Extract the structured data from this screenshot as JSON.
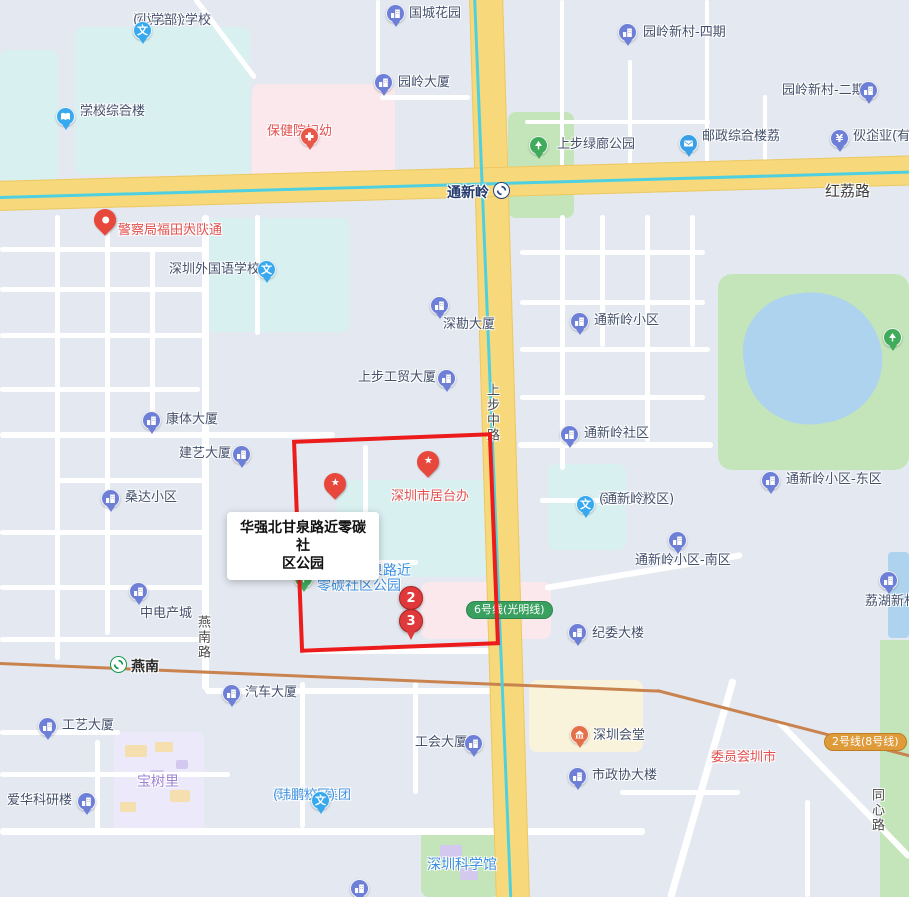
{
  "map": {
    "selection_tooltip": {
      "line1": "华强北甘泉路近零碳社",
      "line2": "区公园"
    },
    "selection_rect_color": "#ed1c1c",
    "colors": {
      "icon_building": "#6d7fd6",
      "icon_school": "#38a9ef",
      "icon_park": "#41ab5c",
      "icon_hospital": "#e8584a",
      "icon_hall_orange": "#e4704a",
      "icon_postal": "#389fe8",
      "pin_red": "#e8473b",
      "marker_red": "#e0393b",
      "label_navy": "#44516d",
      "label_red": "#e25050",
      "label_blue": "#3d8fe0",
      "label_purple": "#9d85d2",
      "line6_green": "#3aa05f",
      "line2_orange": "#df9b3a",
      "road_yellow": "#f7d97b",
      "railway_orange": "#c9834f",
      "metro_cyan": "#4fd0e0"
    },
    "road_labels": [
      {
        "text": "红荔路",
        "x": 825,
        "y": 180,
        "vertical": false,
        "big": true
      },
      {
        "text": "上步中路",
        "x": 482,
        "y": 383,
        "vertical": true,
        "big": false
      },
      {
        "text": "燕南路",
        "x": 193,
        "y": 615,
        "vertical": true,
        "big": false
      },
      {
        "text": "同心路",
        "x": 867,
        "y": 788,
        "vertical": true,
        "big": false
      }
    ],
    "stations": [
      {
        "name": "tongxinling-station",
        "label": "通新岭",
        "icon_x": 501,
        "icon_y": 190,
        "label_x": 436,
        "label_y": 182,
        "logo_color": "#27457c",
        "label_color": "#223a6d"
      },
      {
        "name": "yannan-station",
        "label": "燕南",
        "icon_x": 118,
        "icon_y": 664,
        "label_x": 131,
        "label_y": 656,
        "logo_color": "#14984f",
        "label_color": "#2a2a2a"
      }
    ],
    "metro_badges": [
      {
        "name": "line6-badge",
        "label": "6号线(光明线)",
        "x": 466,
        "y": 601,
        "bg": "#3aa05f",
        "border": "#2e8450"
      },
      {
        "name": "line2-badge",
        "label": "2号线(8号线)",
        "x": 824,
        "y": 733,
        "bg": "#df9b3a",
        "border": "#bf7d22"
      }
    ],
    "numbered_markers": [
      {
        "name": "route-marker-2",
        "n": "2",
        "x": 411,
        "y": 598,
        "shape": "circle"
      },
      {
        "name": "route-marker-3",
        "n": "3",
        "x": 411,
        "y": 621,
        "shape": "pin"
      }
    ],
    "pins": [
      {
        "name": "star-pin-jutaiban",
        "kind": "star",
        "x": 428,
        "y": 475
      },
      {
        "name": "star-pin-obscured",
        "kind": "star",
        "x": 335,
        "y": 497
      },
      {
        "name": "police-pin",
        "kind": "dot",
        "x": 105,
        "y": 233
      },
      {
        "name": "selected-place-pin",
        "kind": "sel",
        "x": 325,
        "y": 570
      }
    ],
    "pois": [
      {
        "name": "sz-experimental-primary",
        "icon": "school",
        "ix": 143,
        "iy": 31,
        "lines": [
          "深圳实验学校",
          "(小学部)"
        ],
        "lx": 133,
        "ly": 14,
        "align": "r",
        "color": "navy"
      },
      {
        "name": "guocheng-garden",
        "icon": "building",
        "ix": 396,
        "iy": 14,
        "lines": [
          "国城花园"
        ],
        "lx": 409,
        "ly": 7,
        "align": "l",
        "color": "navy"
      },
      {
        "name": "experimental-complex",
        "icon": "book",
        "ix": 66,
        "iy": 117,
        "lines": [
          "深圳实验",
          "学校综合楼"
        ],
        "lx": 80,
        "ly": 105,
        "align": "l",
        "color": "navy"
      },
      {
        "name": "fuyou-hospital",
        "icon": "hospital",
        "ix": 310,
        "iy": 137,
        "lines": [
          "深圳市妇幼",
          "保健院"
        ],
        "lx": 267,
        "ly": 125,
        "align": "c",
        "color": "red"
      },
      {
        "name": "yuanling-building",
        "icon": "building",
        "ix": 384,
        "iy": 83,
        "lines": [
          "园岭大厦"
        ],
        "lx": 398,
        "ly": 76,
        "align": "l",
        "color": "navy"
      },
      {
        "name": "yuanling-xincun-4",
        "icon": "building",
        "ix": 628,
        "iy": 33,
        "lines": [
          "园岭新村-四期"
        ],
        "lx": 643,
        "ly": 26,
        "align": "l",
        "color": "navy"
      },
      {
        "name": "yuanling-xincun-2",
        "icon": "building",
        "ix": 869,
        "iy": 91,
        "lines": [
          "园岭新村-二期"
        ],
        "lx": 782,
        "ly": 84,
        "align": "l",
        "color": "navy"
      },
      {
        "name": "lvlang-park",
        "icon": "park",
        "ix": 539,
        "iy": 146,
        "lines": [
          "上步绿廊公园"
        ],
        "lx": 557,
        "ly": 138,
        "align": "l",
        "color": "navy"
      },
      {
        "name": "china-post-hongli",
        "icon": "postal",
        "ix": 689,
        "iy": 144,
        "lines": [
          "中国邮政红荔",
          "邮政综合楼"
        ],
        "lx": 702,
        "ly": 130,
        "align": "l",
        "color": "navy"
      },
      {
        "name": "dream-factory-partnership",
        "icon": "money",
        "ix": 840,
        "iy": 139,
        "lines": [
          "深圳梦厂投",
          "伙企业(有限"
        ],
        "lx": 853,
        "ly": 130,
        "align": "l",
        "color": "navy"
      },
      {
        "name": "traffic-police-futian",
        "icon": null,
        "ix": 0,
        "iy": 0,
        "lines": [
          "深圳市公安局交通",
          "警察局福田大队"
        ],
        "lx": 118,
        "ly": 224,
        "align": "l",
        "color": "red"
      },
      {
        "name": "foreign-language-school",
        "icon": "school",
        "ix": 267,
        "iy": 270,
        "lines": [
          "深圳外国语学校"
        ],
        "lx": 169,
        "ly": 263,
        "align": "l",
        "color": "navy"
      },
      {
        "name": "shenkan-building",
        "icon": "building",
        "ix": 440,
        "iy": 306,
        "lines": [
          "深勘大厦"
        ],
        "lx": 443,
        "ly": 318,
        "align": "c",
        "color": "navy"
      },
      {
        "name": "shangbu-trade-building",
        "icon": "building",
        "ix": 447,
        "iy": 379,
        "lines": [
          "上步工贸大厦"
        ],
        "lx": 358,
        "ly": 371,
        "align": "l",
        "color": "navy"
      },
      {
        "name": "kangti-building",
        "icon": "building",
        "ix": 152,
        "iy": 421,
        "lines": [
          "康体大厦"
        ],
        "lx": 166,
        "ly": 413,
        "align": "l",
        "color": "navy"
      },
      {
        "name": "jianyi-building",
        "icon": "building",
        "ix": 242,
        "iy": 455,
        "lines": [
          "建艺大厦"
        ],
        "lx": 179,
        "ly": 447,
        "align": "l",
        "color": "navy"
      },
      {
        "name": "sangda-xiaoqu",
        "icon": "building",
        "ix": 111,
        "iy": 499,
        "lines": [
          "桑达小区"
        ],
        "lx": 125,
        "ly": 491,
        "align": "l",
        "color": "navy"
      },
      {
        "name": "zhongdian-chancheng",
        "icon": "building",
        "ix": 139,
        "iy": 592,
        "lines": [
          "中电产城"
        ],
        "lx": 140,
        "ly": 607,
        "align": "c",
        "color": "navy"
      },
      {
        "name": "gongyi-building",
        "icon": "building",
        "ix": 48,
        "iy": 727,
        "lines": [
          "工艺大厦"
        ],
        "lx": 62,
        "ly": 719,
        "align": "l",
        "color": "navy"
      },
      {
        "name": "qiche-building",
        "icon": "building",
        "ix": 232,
        "iy": 694,
        "lines": [
          "汽车大厦"
        ],
        "lx": 245,
        "ly": 686,
        "align": "l",
        "color": "navy"
      },
      {
        "name": "baoshuli",
        "icon": null,
        "ix": 0,
        "iy": 0,
        "lines": [
          "宝树里"
        ],
        "lx": 137,
        "ly": 775,
        "align": "l",
        "color": "purple"
      },
      {
        "name": "aihua-research",
        "icon": "building",
        "ix": 87,
        "iy": 802,
        "lines": [
          "爱华科研楼"
        ],
        "lx": 7,
        "ly": 794,
        "align": "l",
        "color": "navy"
      },
      {
        "name": "liyuan-edu-weipeng",
        "icon": "school",
        "ix": 321,
        "iy": 801,
        "lines": [
          "荔园教育集团",
          "(玮鹏校区)"
        ],
        "lx": 273,
        "ly": 789,
        "align": "c",
        "color": "blue"
      },
      {
        "name": "gonghui-building",
        "icon": "building",
        "ix": 474,
        "iy": 744,
        "lines": [
          "工会大厦"
        ],
        "lx": 415,
        "ly": 736,
        "align": "l",
        "color": "navy"
      },
      {
        "name": "shenzhen-huitang",
        "icon": "hall",
        "ix": 580,
        "iy": 735,
        "lines": [
          "深圳会堂"
        ],
        "lx": 593,
        "ly": 729,
        "align": "l",
        "color": "navy"
      },
      {
        "name": "shizhengxie-building",
        "icon": "building",
        "ix": 578,
        "iy": 777,
        "lines": [
          "市政协大楼"
        ],
        "lx": 592,
        "ly": 769,
        "align": "l",
        "color": "navy"
      },
      {
        "name": "cpc-shenzhen-committee",
        "icon": null,
        "ix": 0,
        "iy": 0,
        "lines": [
          "中共深圳市",
          "委员会"
        ],
        "lx": 711,
        "ly": 751,
        "align": "c",
        "color": "red"
      },
      {
        "name": "jiwei-building",
        "icon": "building",
        "ix": 578,
        "iy": 633,
        "lines": [
          "纪委大楼"
        ],
        "lx": 592,
        "ly": 627,
        "align": "l",
        "color": "navy"
      },
      {
        "name": "tongxinling-xiaoqu",
        "icon": "building",
        "ix": 580,
        "iy": 322,
        "lines": [
          "通新岭小区"
        ],
        "lx": 594,
        "ly": 314,
        "align": "l",
        "color": "navy"
      },
      {
        "name": "tongxinling-shequ",
        "icon": "building",
        "ix": 570,
        "iy": 435,
        "lines": [
          "通新岭社区"
        ],
        "lx": 584,
        "ly": 427,
        "align": "l",
        "color": "navy"
      },
      {
        "name": "tongxinling-east",
        "icon": "building",
        "ix": 771,
        "iy": 481,
        "lines": [
          "通新岭小区-东区"
        ],
        "lx": 786,
        "ly": 473,
        "align": "l",
        "color": "navy"
      },
      {
        "name": "liyuan-primary-txl",
        "icon": "school",
        "ix": 586,
        "iy": 505,
        "lines": [
          "荔园小学",
          "(通新岭校区)"
        ],
        "lx": 599,
        "ly": 493,
        "align": "l",
        "color": "navy"
      },
      {
        "name": "tongxinling-south",
        "icon": "building",
        "ix": 678,
        "iy": 541,
        "lines": [
          "通新岭小区-南区"
        ],
        "lx": 635,
        "ly": 554,
        "align": "l",
        "color": "navy"
      },
      {
        "name": "lihu-xincun",
        "icon": "building",
        "ix": 889,
        "iy": 581,
        "lines": [
          "荔湖新村"
        ],
        "lx": 865,
        "ly": 595,
        "align": "l",
        "color": "navy"
      },
      {
        "name": "shenzhen-science-museum",
        "icon": null,
        "ix": 0,
        "iy": 0,
        "lines": [
          "深圳科学馆"
        ],
        "lx": 427,
        "ly": 858,
        "align": "l",
        "color": "big"
      },
      {
        "name": "jutaiban-label",
        "icon": null,
        "ix": 0,
        "iy": 0,
        "lines": [
          "深圳市居台办"
        ],
        "lx": 391,
        "ly": 490,
        "align": "l",
        "color": "red"
      },
      {
        "name": "zero-carbon-park-icon-poi",
        "icon": "park",
        "ix": 304,
        "iy": 579,
        "lines": [],
        "lx": 0,
        "ly": 0,
        "align": "l",
        "color": "navy"
      },
      {
        "name": "zero-carbon-park-label-1",
        "icon": null,
        "ix": 0,
        "iy": 0,
        "lines": [
          "强北甘泉路近"
        ],
        "lx": 327,
        "ly": 564,
        "align": "l",
        "color": "big"
      },
      {
        "name": "zero-carbon-park-label-2",
        "icon": null,
        "ix": 0,
        "iy": 0,
        "lines": [
          "零碳社区公园"
        ],
        "lx": 317,
        "ly": 579,
        "align": "l",
        "color": "big"
      },
      {
        "name": "park-tree-poi",
        "icon": "tree",
        "ix": 893,
        "iy": 338,
        "lines": [],
        "lx": 0,
        "ly": 0,
        "align": "l",
        "color": "navy"
      },
      {
        "name": "bottom-building-poi",
        "icon": "building",
        "ix": 360,
        "iy": 889,
        "lines": [],
        "lx": 0,
        "ly": 0,
        "align": "l",
        "color": "navy"
      }
    ]
  }
}
